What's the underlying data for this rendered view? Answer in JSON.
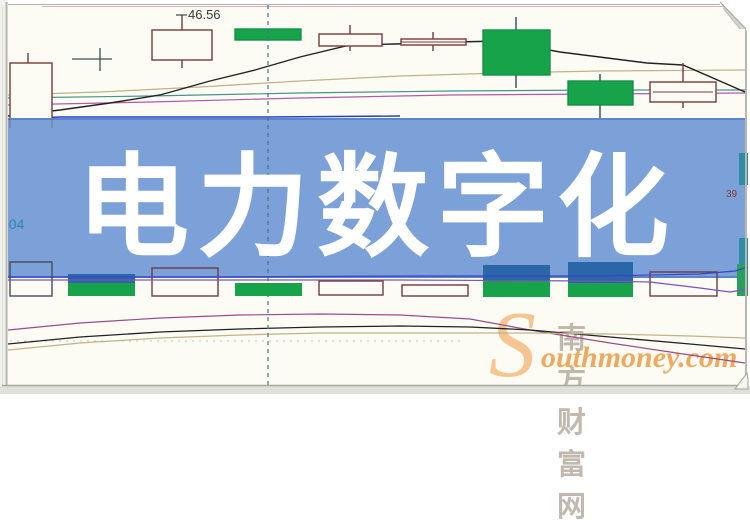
{
  "banner": {
    "title": "电力数字化",
    "bg_color": "#7BA1D8",
    "text_color": "#FFFFFF"
  },
  "labels": {
    "price_annotation": "46.56",
    "left_axis_partial": "004",
    "right_axis_partial": "39"
  },
  "watermark": {
    "cn": "南方财富网",
    "en_initial": "S",
    "en_rest": "outhmoney.com",
    "accent_color": "#EB943A"
  },
  "colors": {
    "chart_background": "#FCFCF4",
    "candle_up_border": "#7A3A3A",
    "candle_down_fill": "#16A34A",
    "volume_blue": "#2B66A8",
    "dashed_crosshair": "#40738F",
    "ma_black": "#222222",
    "ma_tan": "#C2B287",
    "ma_teal": "#46958A",
    "ma_magenta": "#B25AA5",
    "ma_blue": "#2540C8",
    "lower_purple": "#9A4E88"
  },
  "chart_data": {
    "type": "candlestick",
    "title": "电力数字化",
    "annotations": [
      "46.56"
    ],
    "axis_labels_visible": [
      "004",
      "39"
    ],
    "grid": "minimal",
    "legend": "none",
    "series": [
      {
        "name": "price_candles_estimated",
        "note": "values estimated from single visible label 46.56; hollow=up, green=down",
        "candles": [
          {
            "open": 44.32,
            "close": 45.6,
            "high": 45.76,
            "low": 44.26,
            "direction": "up"
          },
          {
            "open": 45.66,
            "close": 46.26,
            "high": 46.56,
            "low": 45.5,
            "direction": "up"
          },
          {
            "open": 46.28,
            "close": 46.06,
            "high": 46.32,
            "low": 46.02,
            "direction": "down"
          },
          {
            "open": 45.94,
            "close": 46.18,
            "high": 46.36,
            "low": 45.82,
            "direction": "up"
          },
          {
            "open": 45.96,
            "close": 46.08,
            "high": 46.22,
            "low": 45.82,
            "direction": "up"
          },
          {
            "open": 46.26,
            "close": 45.36,
            "high": 46.52,
            "low": 45.1,
            "direction": "down"
          },
          {
            "open": 45.24,
            "close": 44.76,
            "high": 45.38,
            "low": 44.38,
            "direction": "down"
          },
          {
            "open": 44.82,
            "close": 45.22,
            "high": 45.6,
            "low": 44.7,
            "direction": "up"
          }
        ]
      },
      {
        "name": "volume_relative",
        "values": [
          31,
          22,
          28,
          13,
          14,
          11,
          32,
          35,
          24,
          34
        ],
        "bar_styles": [
          "hollow",
          "filled",
          "hollow",
          "filled",
          "hollow",
          "hollow",
          "filled",
          "filled",
          "hollow",
          "filled"
        ]
      }
    ],
    "overlays": [
      "moving-average lines in price pane: black, tan, teal, magenta, blue",
      "indicator curves in lower pane: purple, black, tan",
      "vertical dashed crosshair line",
      "dotted horizontal gridline in lower pane"
    ]
  }
}
